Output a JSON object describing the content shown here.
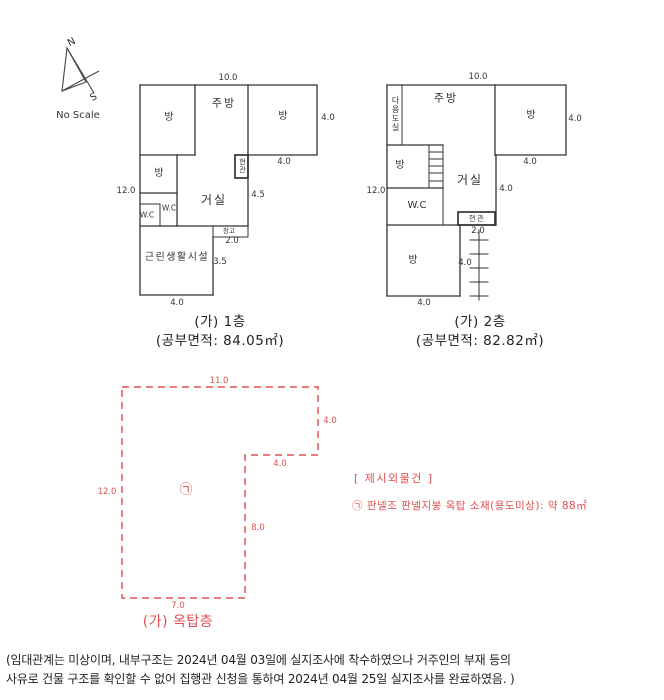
{
  "compass": {
    "north": "N",
    "south": "S",
    "scale_note": "No Scale"
  },
  "floor1": {
    "caption": "(가) 1층",
    "area": "(공부면적: 84.05㎡)",
    "rooms": {
      "room_top_left": "방",
      "kitchen": "주방",
      "room_top_right": "방",
      "entrance": "현관",
      "room_mid_left": "방",
      "living": "거실",
      "wc_inner": "W.C",
      "wc_outer": "W.C",
      "storage": "창고",
      "facility": "근린생활시설"
    },
    "dims": {
      "top": "10.0",
      "right": "4.0",
      "tr_bottom": "4.0",
      "left": "12.0",
      "living_right": "4.5",
      "storage_depth": "2.0",
      "facility_right": "3.5",
      "bottom": "4.0"
    }
  },
  "floor2": {
    "caption": "(가) 2층",
    "area": "(공부면적: 82.82㎡)",
    "rooms": {
      "utility": "다용도실",
      "kitchen": "주방",
      "room_top_right": "방",
      "room_mid_left": "방",
      "living": "거실",
      "wc": "W.C",
      "entrance": "현관",
      "room_bottom": "방"
    },
    "dims": {
      "top": "10.0",
      "right": "4.0",
      "tr_bottom": "4.0",
      "left": "12.0",
      "living_right": "4.0",
      "entrance_depth": "2.0",
      "stair_side": "4.0",
      "bottom": "4.0"
    }
  },
  "rooftop": {
    "caption": "(가)  옥탑층",
    "mark": "㉠",
    "dims": {
      "top": "11.0",
      "right": "4.0",
      "notch": "4.0",
      "left": "12.0",
      "inner_right": "8.0",
      "bottom": "7.0"
    }
  },
  "notes": {
    "heading": "[ 제시외물건 ]",
    "item": "㉠ 판넬조 판넬지붕 옥탑 소재(용도미상): 약 88㎡"
  },
  "footer": {
    "line1": "(임대관계는 미상이며, 내부구조는 2024년 04월 03일에 실지조사에 착수하였으나 거주인의 부재 등의",
    "line2": "사유로 건물 구조를 확인할 수 없어 집행관 신청을 통하여 2024년 04월 25일 실지조사를 완료하였음. )"
  },
  "colors": {
    "line": "#333333",
    "accent_red": "#e05050"
  }
}
